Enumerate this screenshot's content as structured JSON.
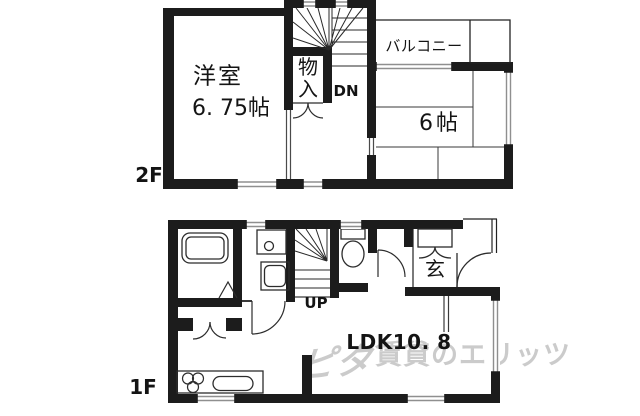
{
  "floor2": {
    "label": "2F",
    "western_room": {
      "name": "洋室",
      "size": "6. 75帖"
    },
    "closet_label": "物入",
    "stairs_label": "DN",
    "balcony_label": "バルコニー",
    "japanese_room": {
      "size": "6帖"
    }
  },
  "floor1": {
    "label": "1F",
    "stairs_label": "UP",
    "entrance_label": "玄",
    "ldk_label": "LDK10. 8"
  },
  "watermark": {
    "logo": "ピタ",
    "text": "賃貸のエリッツ"
  },
  "colors": {
    "wall": "#1c1c1c",
    "thin_line": "#2e2e2e",
    "window_line": "#8f8f8f",
    "watermark": "#cbcbcb",
    "background": "#ffffff"
  }
}
